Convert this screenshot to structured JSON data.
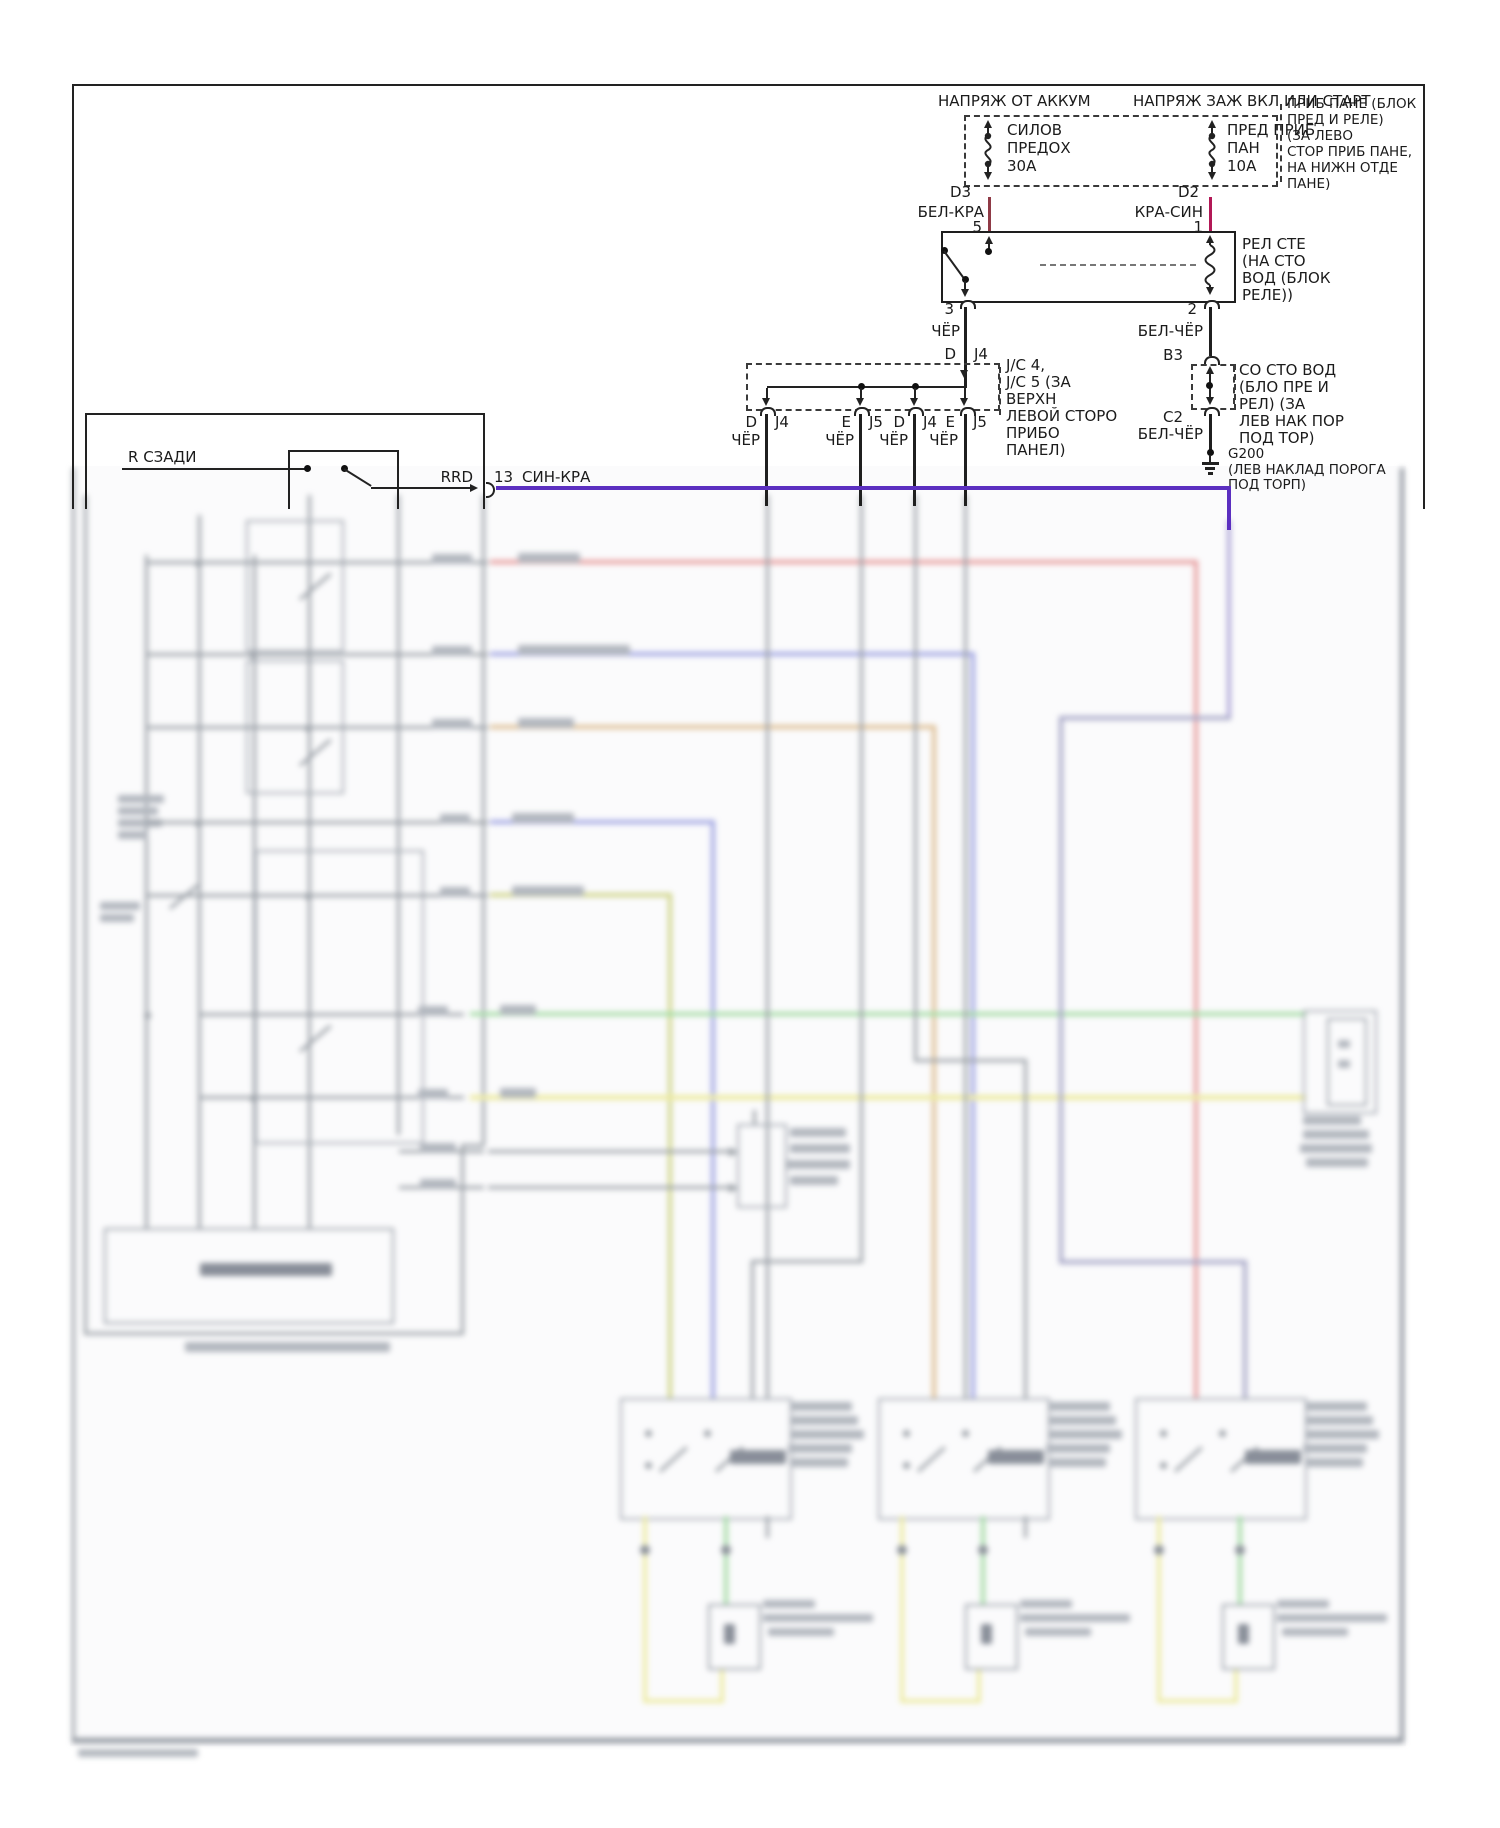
{
  "colors": {
    "wire_bel_kra": "#8f3a46",
    "wire_kra_sin": "#b21856",
    "wire_sin_kra": "#5b2fc0",
    "wire_black": "#1f1f1f",
    "blur_red": "#eb9d9d",
    "blur_blue": "#a2a7e6",
    "blur_tan": "#e2c193",
    "blur_olive": "#d2d787",
    "blur_green": "#a5e0a5",
    "blur_yellow": "#f1efa2",
    "blur_gray": "#9aa0a6"
  },
  "header": {
    "battery_feed": "НАПРЯЖ ОТ АККУМ",
    "ignition_feed": "НАПРЯЖ ЗАЖ ВКЛ ИЛИ СТАРТ"
  },
  "fuse_box": {
    "fuse1": {
      "lines": [
        "СИЛОВ",
        "ПРЕДОХ",
        "30А"
      ],
      "pin": "D3"
    },
    "fuse2": {
      "lines": [
        "ПРЕД ПРИБ",
        "ПАН",
        "10А"
      ],
      "pin": "D2"
    },
    "note": [
      "ПРИБ ПАНЕ (БЛОК",
      "ПРЕД И РЕЛЕ)",
      "(ЗА ЛЕВО",
      "СТОР ПРИБ ПАНЕ,",
      "НА НИЖН ОТДЕ",
      "ПАНЕ)"
    ]
  },
  "wires": {
    "bel_kra": "БЕЛ-КРА",
    "kra_sin": "КРА-СИН",
    "cher": "ЧЁР",
    "bel_cher": "БЕЛ-ЧЁР",
    "sin_kra": "СИН-КРА"
  },
  "pins": {
    "p5": "5",
    "p1": "1",
    "p3": "3",
    "p2": "2",
    "b3": "B3",
    "c2": "C2",
    "p13": "13",
    "d": "D",
    "e": "E",
    "j4": "J4",
    "j5": "J5"
  },
  "relay": {
    "note": [
      "РЕЛ СТЕ",
      "(НА СТО",
      "ВОД (БЛОК",
      "РЕЛЕ))"
    ]
  },
  "junction": {
    "note": [
      "J/C 4,",
      "J/C 5 (ЗА",
      "ВЕРХН",
      "ЛЕВОЙ СТОРО",
      "ПРИБО",
      "ПАНЕЛ)"
    ]
  },
  "b3_box": {
    "note": [
      "СО СТО ВОД",
      "(БЛО ПРЕ И",
      "РЕЛ) (ЗА",
      "ЛЕВ НАК ПОР",
      "ПОД ТОР)"
    ]
  },
  "ground": {
    "id": "G200",
    "note": [
      "(ЛЕВ НАКЛАД ПОРОГА",
      "ПОД ТОРП)"
    ]
  },
  "left_switch": {
    "label": "R СЗАДИ",
    "rrd": "RRD"
  }
}
